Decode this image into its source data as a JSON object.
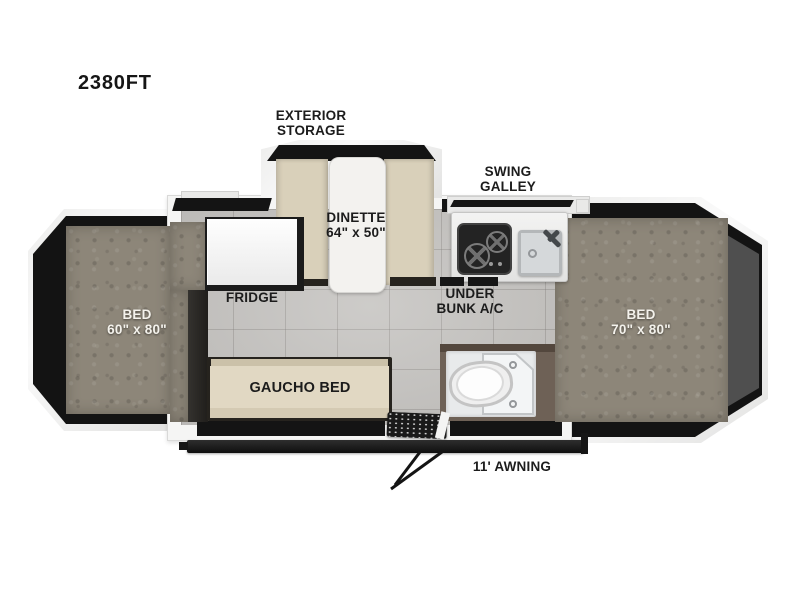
{
  "model": "2380FT",
  "labels": {
    "exterior_storage": {
      "line1": "EXTERIOR",
      "line2": "STORAGE"
    },
    "swing_galley": {
      "line1": "SWING",
      "line2": "GALLEY"
    },
    "dinette": {
      "line1": "DINETTE",
      "line2": "64\" x 50\""
    },
    "fridge": "FRIDGE",
    "under_bunk_ac": {
      "line1": "UNDER",
      "line2": "BUNK A/C"
    },
    "bed_left": {
      "line1": "BED",
      "line2": "60\" x 80\""
    },
    "bed_right": {
      "line1": "BED",
      "line2": "70\" x 80\""
    },
    "gaucho_bed": "GAUCHO BED",
    "awning": "11' AWNING"
  },
  "icons": {
    "stove": "two-burner-cooktop",
    "sink": "square-sink-with-faucet",
    "toilet": "toilet",
    "shower": "shower-pan-with-drains",
    "entry_step": "entry-step-grate",
    "awning_arm": "awning-support-arm"
  },
  "colors": {
    "background": "#ffffff",
    "shell_white": "#f5f5f4",
    "accent_black": "#141414",
    "mattress_gray": "#8d8679",
    "floor_tile": "#c4c2bf",
    "cushion_tan": "#d9d0ba",
    "bathroom_wall": "#6e6156",
    "tent_end_gray": "#4f4f4f",
    "label_dark": "#1c1c1c",
    "label_light": "#f4f2ec"
  }
}
